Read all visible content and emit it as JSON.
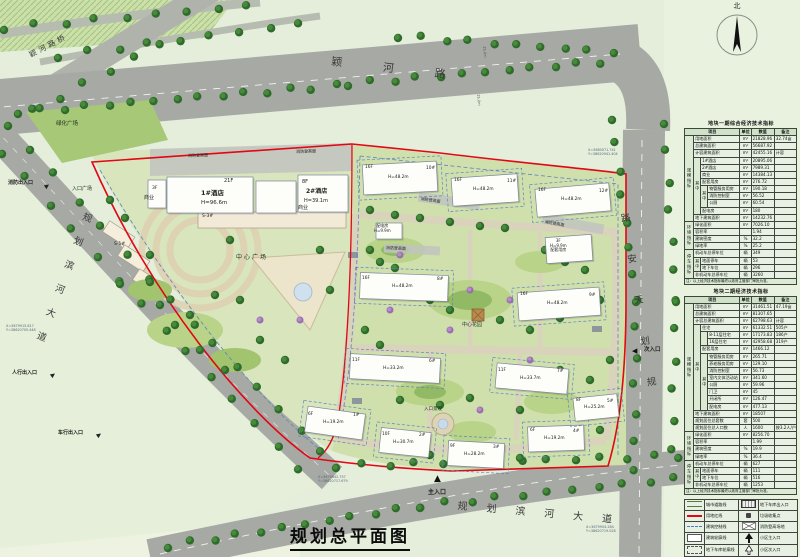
{
  "title": {
    "plan": "规划总平面图"
  },
  "compass": {
    "north": "北"
  },
  "roads": {
    "yinghe_bridge": "颖河路桥",
    "yinghe": "颖河路",
    "binhe_left": "规划滨河大道",
    "binhe_bottom": "规划滨河大道",
    "tianan": "路安天划规",
    "dim1": "25.0m",
    "dim2": "25.0m"
  },
  "labels": {
    "green_plaza": "绿化广场",
    "entrance_plaza": "入口广场",
    "center_plaza": "中心广场",
    "center_garden": "中心花园",
    "commercial_a": "商业",
    "commercial_b": "商业",
    "s1": "S-1#",
    "s3": "S-3#",
    "entrance_landscape": "入口景观",
    "fire_access": "消防登高面",
    "power_room": "配电房",
    "power_h": "H=9.9m",
    "support_f": "3F",
    "support_h": "H=9.9m",
    "support_name": "配套用房"
  },
  "entrances": {
    "fire": "消防出入口",
    "pedestrian": "人行出入口",
    "vehicle": "车行出入口",
    "main": "主入口",
    "secondary": "次入口"
  },
  "buildings": {
    "hotel1": {
      "floors": "21F",
      "name": "1#酒店",
      "height": "H=96.6m",
      "annex": "3F"
    },
    "hotel2": {
      "floors": "8F",
      "name": "2#酒店",
      "height": "H=39.1m"
    },
    "residential": [
      {
        "floors": "16F",
        "height": "H=48.2m",
        "no": "10#"
      },
      {
        "floors": "16F",
        "height": "H=48.2m",
        "no": "11#"
      },
      {
        "floors": "16F",
        "height": "H=48.2m",
        "no": "12#"
      },
      {
        "floors": "16F",
        "height": "H=48.2m",
        "no": "8#"
      },
      {
        "floors": "16F",
        "height": "H=48.2m",
        "no": "9#"
      },
      {
        "floors": "11F",
        "height": "H=33.2m",
        "no": "6#"
      },
      {
        "floors": "11F",
        "height": "H=33.7m",
        "no": "7#"
      },
      {
        "floors": "6F",
        "height": "H=19.2m",
        "no": "1#"
      },
      {
        "floors": "10F",
        "height": "H=30.7m",
        "no": "2#"
      },
      {
        "floors": "9F",
        "height": "H=28.2m",
        "no": "3#"
      },
      {
        "floors": "6F",
        "height": "H=19.2m",
        "no": "4#"
      },
      {
        "floors": "8F",
        "height": "H=25.2m",
        "no": "5#"
      }
    ]
  },
  "coordinates": [
    {
      "l1": "X=3679915.817",
      "l2": "Y=38620705.448"
    },
    {
      "l1": "X=3679842.757",
      "l2": "Y=38620717.679"
    },
    {
      "l1": "X=3679904.284",
      "l2": "Y=38620719.028"
    },
    {
      "l1": "X=3680071.741",
      "l2": "Y=38620941.404"
    }
  ],
  "table1": {
    "title": "地块一期综合经济技术指标",
    "headers": [
      "项目",
      "单位",
      "数值",
      "备注"
    ],
    "rows": [
      {
        "g": [
          "规模指标",
          12
        ],
        "item": [
          "用地面积",
          3
        ],
        "unit": "m²",
        "val": "21828.96",
        "note": "32.74亩"
      },
      {
        "item": [
          "总建筑面积",
          3
        ],
        "unit": "m²",
        "val": "56687.92",
        "note": ""
      },
      {
        "item": [
          "计容建筑面积",
          3
        ],
        "unit": "m²",
        "val": "42455.16",
        "note": "计容"
      },
      {
        "s1": [
          "其中",
          8
        ],
        "item": [
          "1#酒店",
          2
        ],
        "unit": "m²",
        "val": "20895.06",
        "note": ""
      },
      {
        "item": [
          "2#酒店",
          2
        ],
        "unit": "m²",
        "val": "7989.31",
        "note": ""
      },
      {
        "item": [
          "商业",
          2
        ],
        "unit": "m²",
        "val": "14384.13",
        "note": ""
      },
      {
        "item": [
          "配套用房",
          2
        ],
        "unit": "m²",
        "val": "276.72",
        "note": ""
      },
      {
        "s2": [
          "其中",
          3
        ],
        "item": [
          "物管服务用房",
          1
        ],
        "unit": "m²",
        "val": "190.18",
        "note": ""
      },
      {
        "item": [
          "消防控制室",
          1
        ],
        "unit": "m²",
        "val": "56.52",
        "note": ""
      },
      {
        "item": [
          "公厕",
          1
        ],
        "unit": "m²",
        "val": "60.54",
        "note": ""
      },
      {
        "item": [
          "配电房",
          2
        ],
        "unit": "m²",
        "val": "180",
        "note": ""
      },
      {
        "item": [
          "地下建筑面积",
          3
        ],
        "unit": "m²",
        "val": "14232.76",
        "note": ""
      },
      {
        "g": [
          "环境指标",
          4
        ],
        "item": [
          "绿化面积",
          3
        ],
        "unit": "m²",
        "val": "7026.10",
        "note": ""
      },
      {
        "item": [
          "容积率",
          3
        ],
        "unit": "",
        "val": "1.94",
        "note": ""
      },
      {
        "item": [
          "建筑密度",
          3
        ],
        "unit": "%",
        "val": "32.2",
        "note": ""
      },
      {
        "item": [
          "绿地率",
          3
        ],
        "unit": "%",
        "val": "25.2",
        "note": ""
      },
      {
        "g": [
          "停车指标",
          4
        ],
        "item": [
          "机动车总停车位",
          3
        ],
        "unit": "辆",
        "val": "349",
        "note": ""
      },
      {
        "s1": [
          "其中",
          2
        ],
        "item": [
          "地面停车",
          2
        ],
        "unit": "辆",
        "val": "53",
        "note": ""
      },
      {
        "item": [
          "地下车位",
          2
        ],
        "unit": "辆",
        "val": "296",
        "note": ""
      },
      {
        "item": [
          "非机动车总停车位",
          3
        ],
        "unit": "辆",
        "val": "3260",
        "note": ""
      }
    ],
    "note": "注：以上经济技术指标最终以政府主管部门审批为准。"
  },
  "table2": {
    "title": "地块二期经济技术指标",
    "headers": [
      "项目",
      "单位",
      "数值",
      "备注"
    ],
    "rows": [
      {
        "g": [
          "规模指标",
          18
        ],
        "item": [
          "用地面积",
          3
        ],
        "unit": "m²",
        "val": "31461.51",
        "note": "47.19亩"
      },
      {
        "item": [
          "总建筑面积",
          3
        ],
        "unit": "m²",
        "val": "81307.65",
        "note": ""
      },
      {
        "item": [
          "计容总建筑面积",
          3
        ],
        "unit": "m²",
        "val": "62798.63",
        "note": "计容"
      },
      {
        "s1": [
          "其中",
          12
        ],
        "item": [
          "住宅",
          2
        ],
        "unit": "m²",
        "val": "61332.51",
        "note": "505户"
      },
      {
        "s2": [
          "",
          2
        ],
        "item": [
          "8-11层住宅",
          1
        ],
        "unit": "m²",
        "val": "17173.83",
        "note": "186户"
      },
      {
        "item": [
          "16层住宅",
          1
        ],
        "unit": "m²",
        "val": "42958.68",
        "note": "319户"
      },
      {
        "item": [
          "配套用房",
          2
        ],
        "unit": "m²",
        "val": "1466.12",
        "note": ""
      },
      {
        "s2": [
          "其中",
          8
        ],
        "item": [
          "物管服务用房",
          1
        ],
        "unit": "m²",
        "val": "265.71",
        "note": ""
      },
      {
        "item": [
          "养老服务用房",
          1
        ],
        "unit": "m²",
        "val": "129.10",
        "note": ""
      },
      {
        "item": [
          "消防控制室",
          1
        ],
        "unit": "m²",
        "val": "56.73",
        "note": ""
      },
      {
        "item": [
          "室内文体活动站",
          1
        ],
        "unit": "m²",
        "val": "341.60",
        "note": ""
      },
      {
        "item": [
          "公厕",
          1
        ],
        "unit": "m²",
        "val": "59.96",
        "note": ""
      },
      {
        "item": [
          "门卫",
          1
        ],
        "unit": "m²",
        "val": "45",
        "note": ""
      },
      {
        "item": [
          "开闭所",
          1
        ],
        "unit": "m²",
        "val": "126.47",
        "note": ""
      },
      {
        "item": [
          "配电房",
          1
        ],
        "unit": "m²",
        "val": "477.13",
        "note": ""
      },
      {
        "item": [
          "地下建筑面积",
          3
        ],
        "unit": "m²",
        "val": "18507",
        "note": ""
      },
      {
        "item": [
          "规划居住总套数",
          3
        ],
        "unit": "套",
        "val": "500",
        "note": ""
      },
      {
        "item": [
          "规划居住总人口数",
          3
        ],
        "unit": "人",
        "val": "1600",
        "note": "按3.2人/户"
      },
      {
        "g": [
          "环境指标",
          4
        ],
        "item": [
          "绿化面积",
          3
        ],
        "unit": "m²",
        "val": "8256.70",
        "note": ""
      },
      {
        "item": [
          "容积率",
          3
        ],
        "unit": "",
        "val": "1.99",
        "note": ""
      },
      {
        "item": [
          "建筑密度",
          3
        ],
        "unit": "%",
        "val": "19.9",
        "note": ""
      },
      {
        "item": [
          "绿地率",
          3
        ],
        "unit": "%",
        "val": "36.4",
        "note": ""
      },
      {
        "g": [
          "停车指标",
          4
        ],
        "item": [
          "机动车总停车位",
          3
        ],
        "unit": "辆",
        "val": "627",
        "note": ""
      },
      {
        "s1": [
          "其中",
          2
        ],
        "item": [
          "地面停车",
          2
        ],
        "unit": "辆",
        "val": "111",
        "note": ""
      },
      {
        "item": [
          "地下车位",
          2
        ],
        "unit": "辆",
        "val": "516",
        "note": ""
      },
      {
        "item": [
          "非机动车总停车位",
          3
        ],
        "unit": "辆",
        "val": "1253",
        "note": ""
      }
    ],
    "note": "注：以上经济技术指标最终以政府主管部门审批为准。"
  },
  "legend": {
    "rows": [
      {
        "ls": "city-road",
        "ll": "城市道路线",
        "rs": "garage-entry",
        "rl": "地下车库出入口"
      },
      {
        "ls": "red-line",
        "ll": "用地红线",
        "rs": "trash",
        "rl": "垃圾收集点"
      },
      {
        "ls": "control-line",
        "ll": "建筑控制线",
        "rs": "fire-field",
        "rl": "消防登高场地"
      },
      {
        "ls": "outline-rect",
        "ll": "建筑轮廓线",
        "rs": "main-arrow",
        "rl": "小区主入口"
      },
      {
        "ls": "garage-rect",
        "ll": "地下车库轮廓线",
        "rs": "sec-arrow",
        "rl": "小区次入口"
      }
    ]
  }
}
